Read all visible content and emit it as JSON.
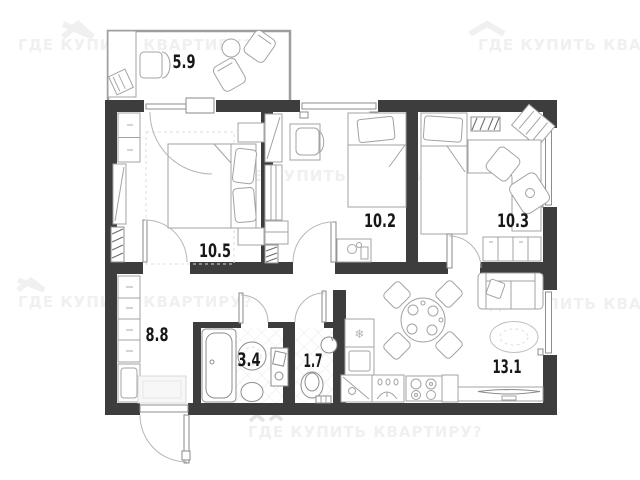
{
  "watermark": {
    "text": "ГДЕ КУПИТЬ КВАРТИРУ?",
    "color": "#f0f0f0"
  },
  "plan": {
    "rooms": [
      {
        "name": "balcony",
        "area_label": "5.9"
      },
      {
        "name": "bedroom-1",
        "area_label": "10.5"
      },
      {
        "name": "bedroom-2",
        "area_label": "10.2"
      },
      {
        "name": "bedroom-3",
        "area_label": "10.3"
      },
      {
        "name": "hallway",
        "area_label": "8.8"
      },
      {
        "name": "bathroom",
        "area_label": "3.4"
      },
      {
        "name": "toilet",
        "area_label": "1.7"
      },
      {
        "name": "kitchen-living-room",
        "area_label": "13.1"
      }
    ],
    "colors": {
      "walls": "#3d3d3d",
      "furniture_stroke": "#a3a3a3",
      "labels": "#181818",
      "watermark": "#f0f0f0"
    },
    "icons": {
      "refrigerator-snowflake": "❄"
    }
  }
}
